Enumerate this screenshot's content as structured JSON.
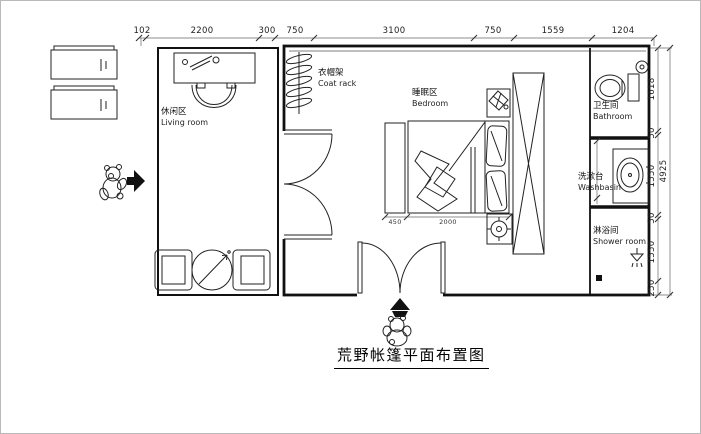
{
  "title": "荒野帐篷平面布置图",
  "labels": {
    "living": {
      "zh": "休闲区",
      "en": "Living room"
    },
    "coat_rack": {
      "zh": "衣帽架",
      "en": "Coat rack"
    },
    "bedroom": {
      "zh": "睡眠区",
      "en": "Bedroom"
    },
    "bathroom": {
      "zh": "卫生间",
      "en": "Bathroom"
    },
    "washbasin": {
      "zh": "洗漱台",
      "en": "Washbasin"
    },
    "shower": {
      "zh": "淋浴间",
      "en": "Shower room"
    }
  },
  "dimensions": {
    "top": [
      "102",
      "2200",
      "300",
      "750",
      "3100",
      "750",
      "1559",
      "1204"
    ],
    "right": [
      "1618",
      "50",
      "1550",
      "50",
      "1550",
      "250"
    ],
    "right_total": "4925",
    "bed": [
      "450",
      "2000"
    ]
  },
  "colors": {
    "wall": "#111111",
    "line": "#222222",
    "dim_text": "#333333"
  }
}
